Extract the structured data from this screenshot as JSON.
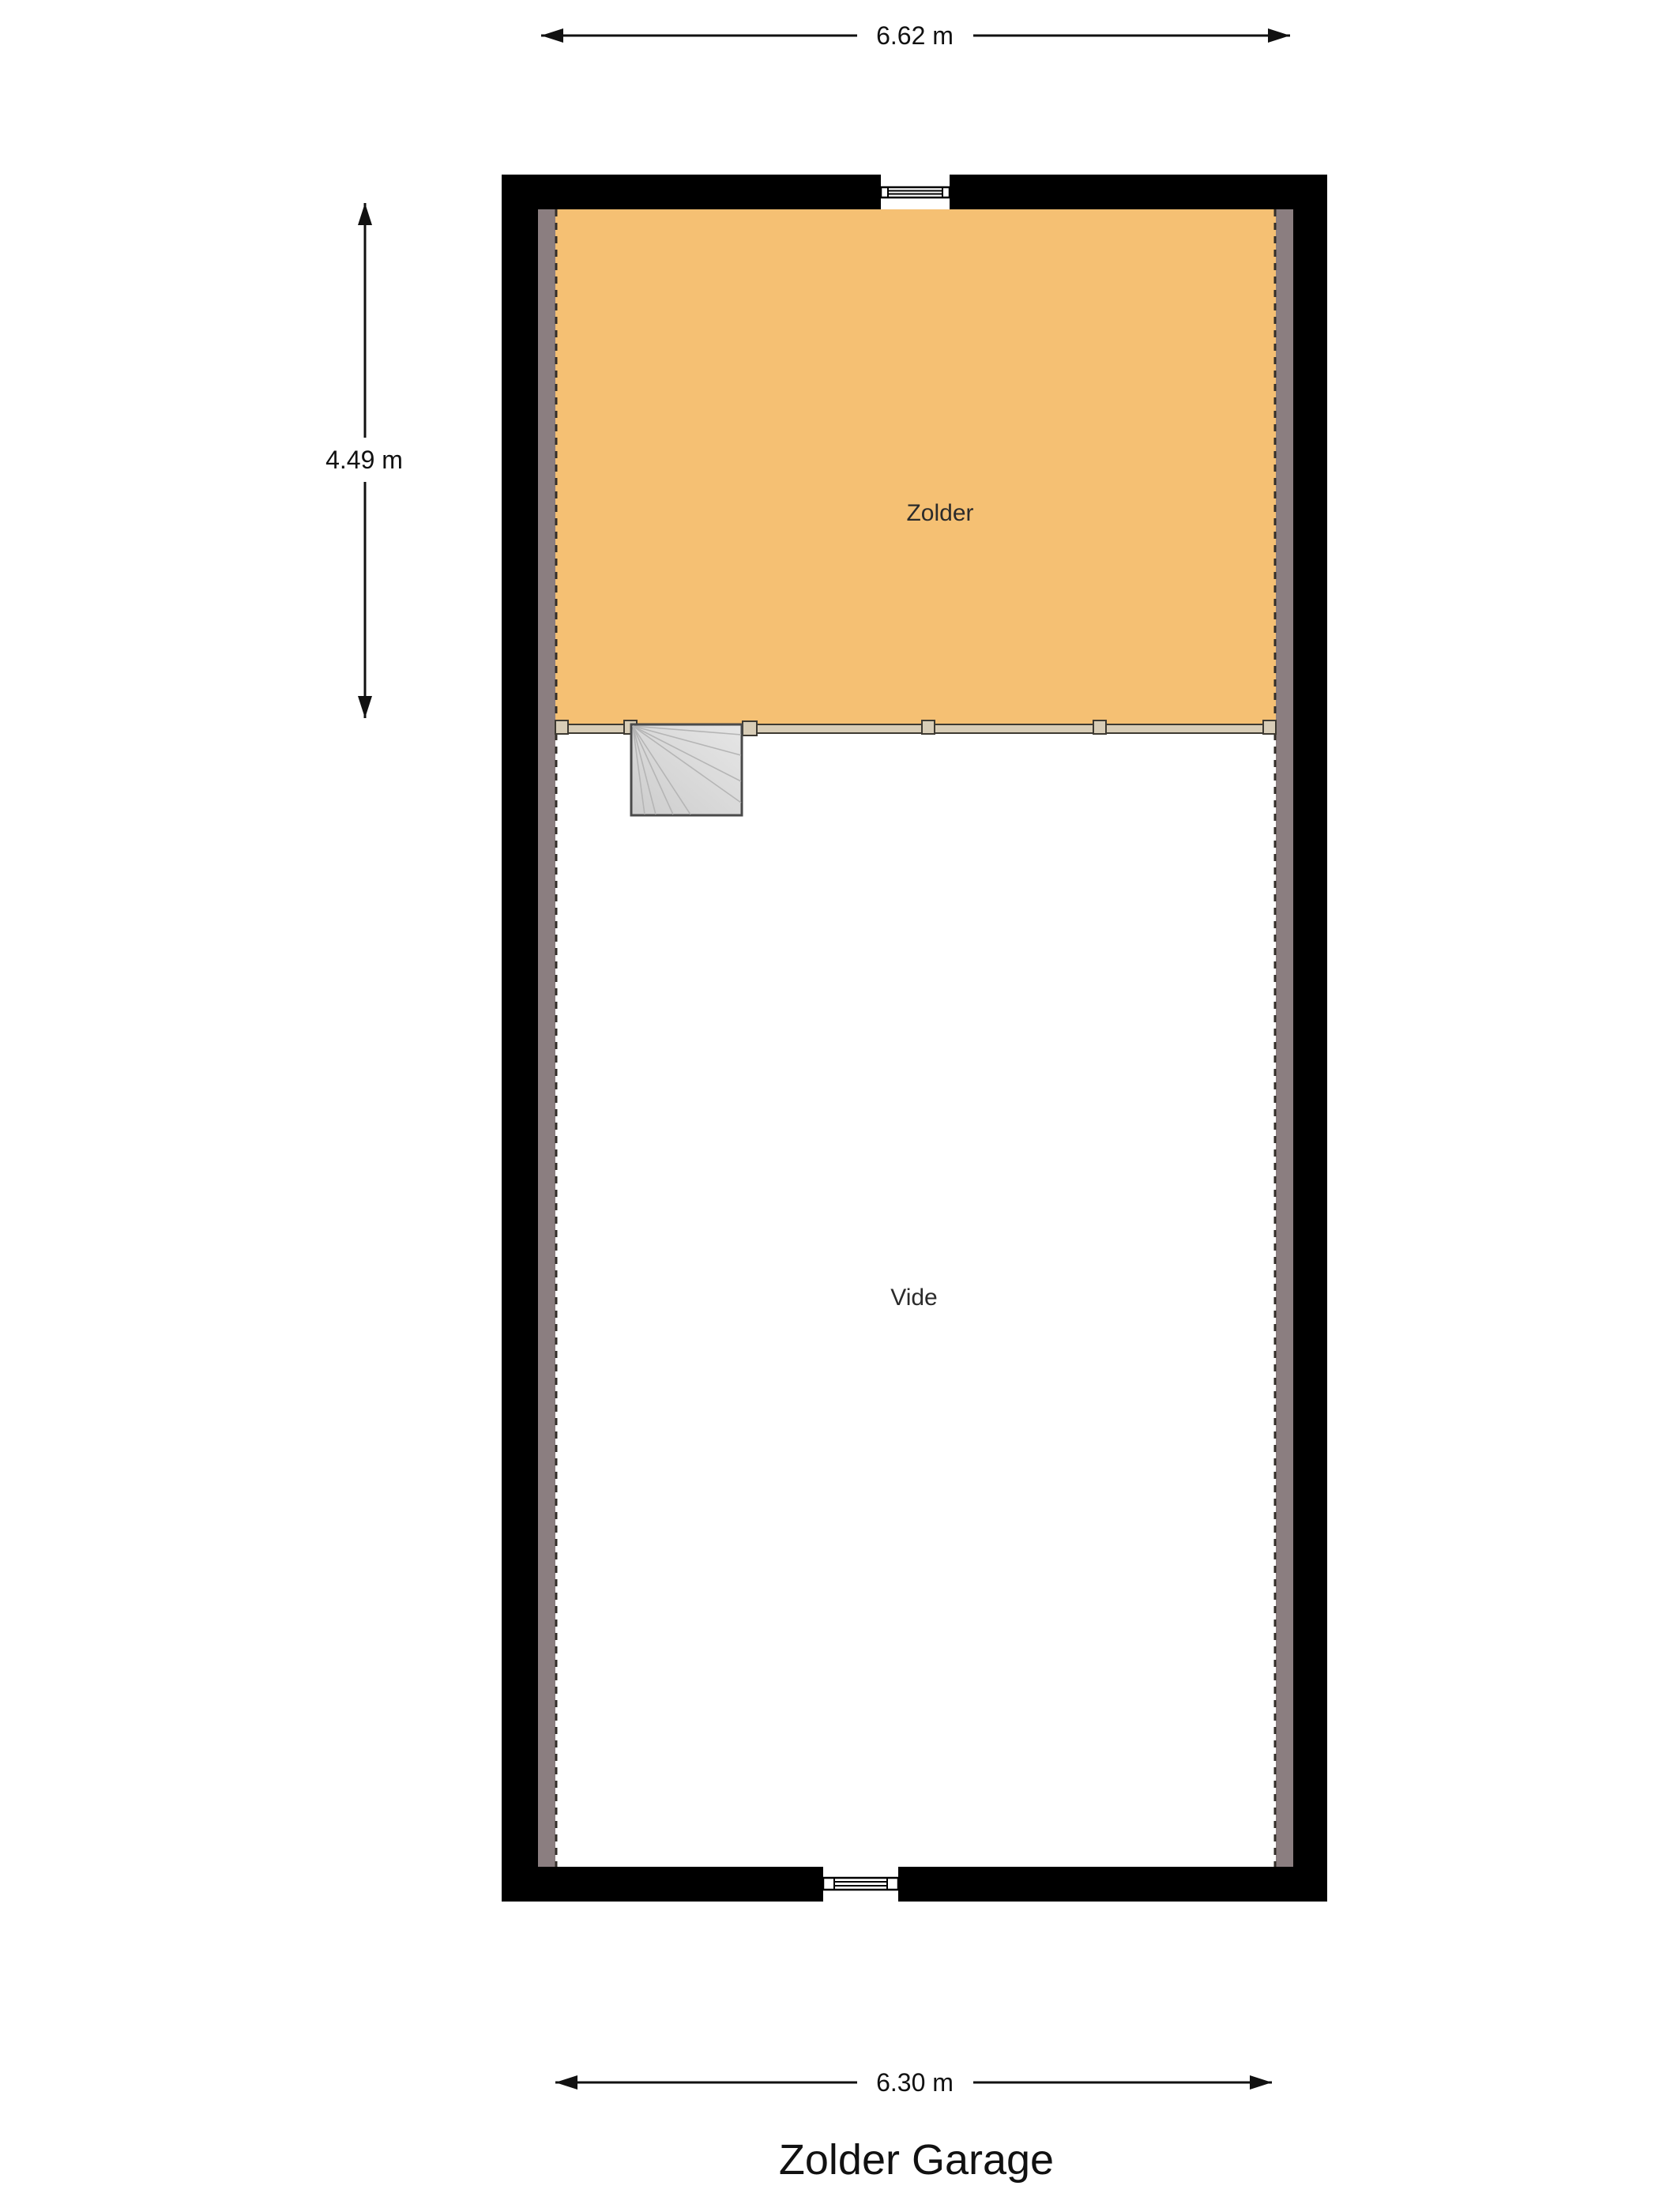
{
  "title": "Zolder Garage",
  "rooms": {
    "zolder": "Zolder",
    "vide": "Vide"
  },
  "dimensions": {
    "top": "6.62 m",
    "left": "4.49 m",
    "bottom": "6.30 m"
  },
  "colors": {
    "wall": "#000000",
    "wall_finish": "#8B7E80",
    "zolder_floor": "#F5C073",
    "vide_floor": "#FFFFFF",
    "railing_fill": "#D8CDB7",
    "stair_fill_light": "#E6E6E6",
    "stair_fill_dark": "#CDCDCD",
    "stair_line": "#B5B5B5",
    "dashed_line": "#332E29"
  }
}
